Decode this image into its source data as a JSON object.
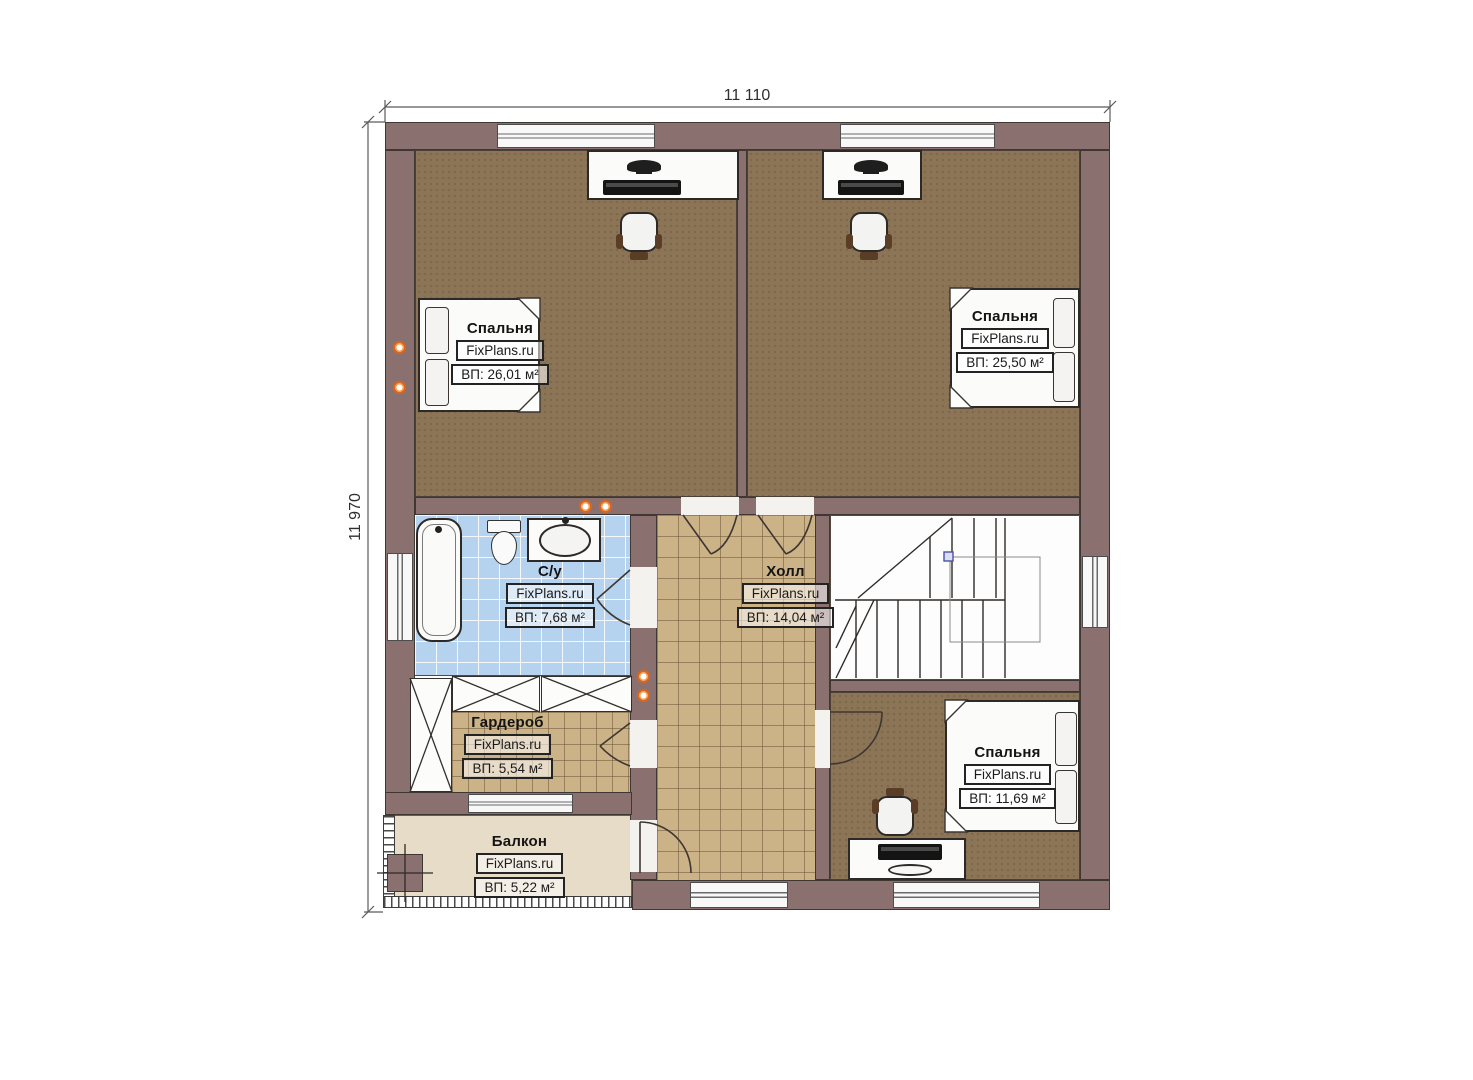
{
  "dimensions": {
    "top": "11 110",
    "left": "11 970"
  },
  "brand": "FixPlans.ru",
  "rooms": [
    {
      "name": "Спальня",
      "site": "FixPlans.ru",
      "area": "ВП: 26,01 м²"
    },
    {
      "name": "Спальня",
      "site": "FixPlans.ru",
      "area": "ВП: 25,50 м²"
    },
    {
      "name": "С/у",
      "site": "FixPlans.ru",
      "area": "ВП: 7,68 м²"
    },
    {
      "name": "Холл",
      "site": "FixPlans.ru",
      "area": "ВП: 14,04 м²"
    },
    {
      "name": "Гардероб",
      "site": "FixPlans.ru",
      "area": "ВП: 5,54 м²"
    },
    {
      "name": "Спальня",
      "site": "FixPlans.ru",
      "area": "ВП: 11,69 м²"
    },
    {
      "name": "Балкон",
      "site": "FixPlans.ru",
      "area": "ВП: 5,22 м²"
    }
  ],
  "colors": {
    "wall": "#8a7170",
    "bedroom_floor": "#8c7456",
    "hall_tile": "#ccb287",
    "bathroom_tile": "#b5d2ee",
    "balcony_floor": "#e7dcc7",
    "marker_orange": "#dd651b"
  }
}
